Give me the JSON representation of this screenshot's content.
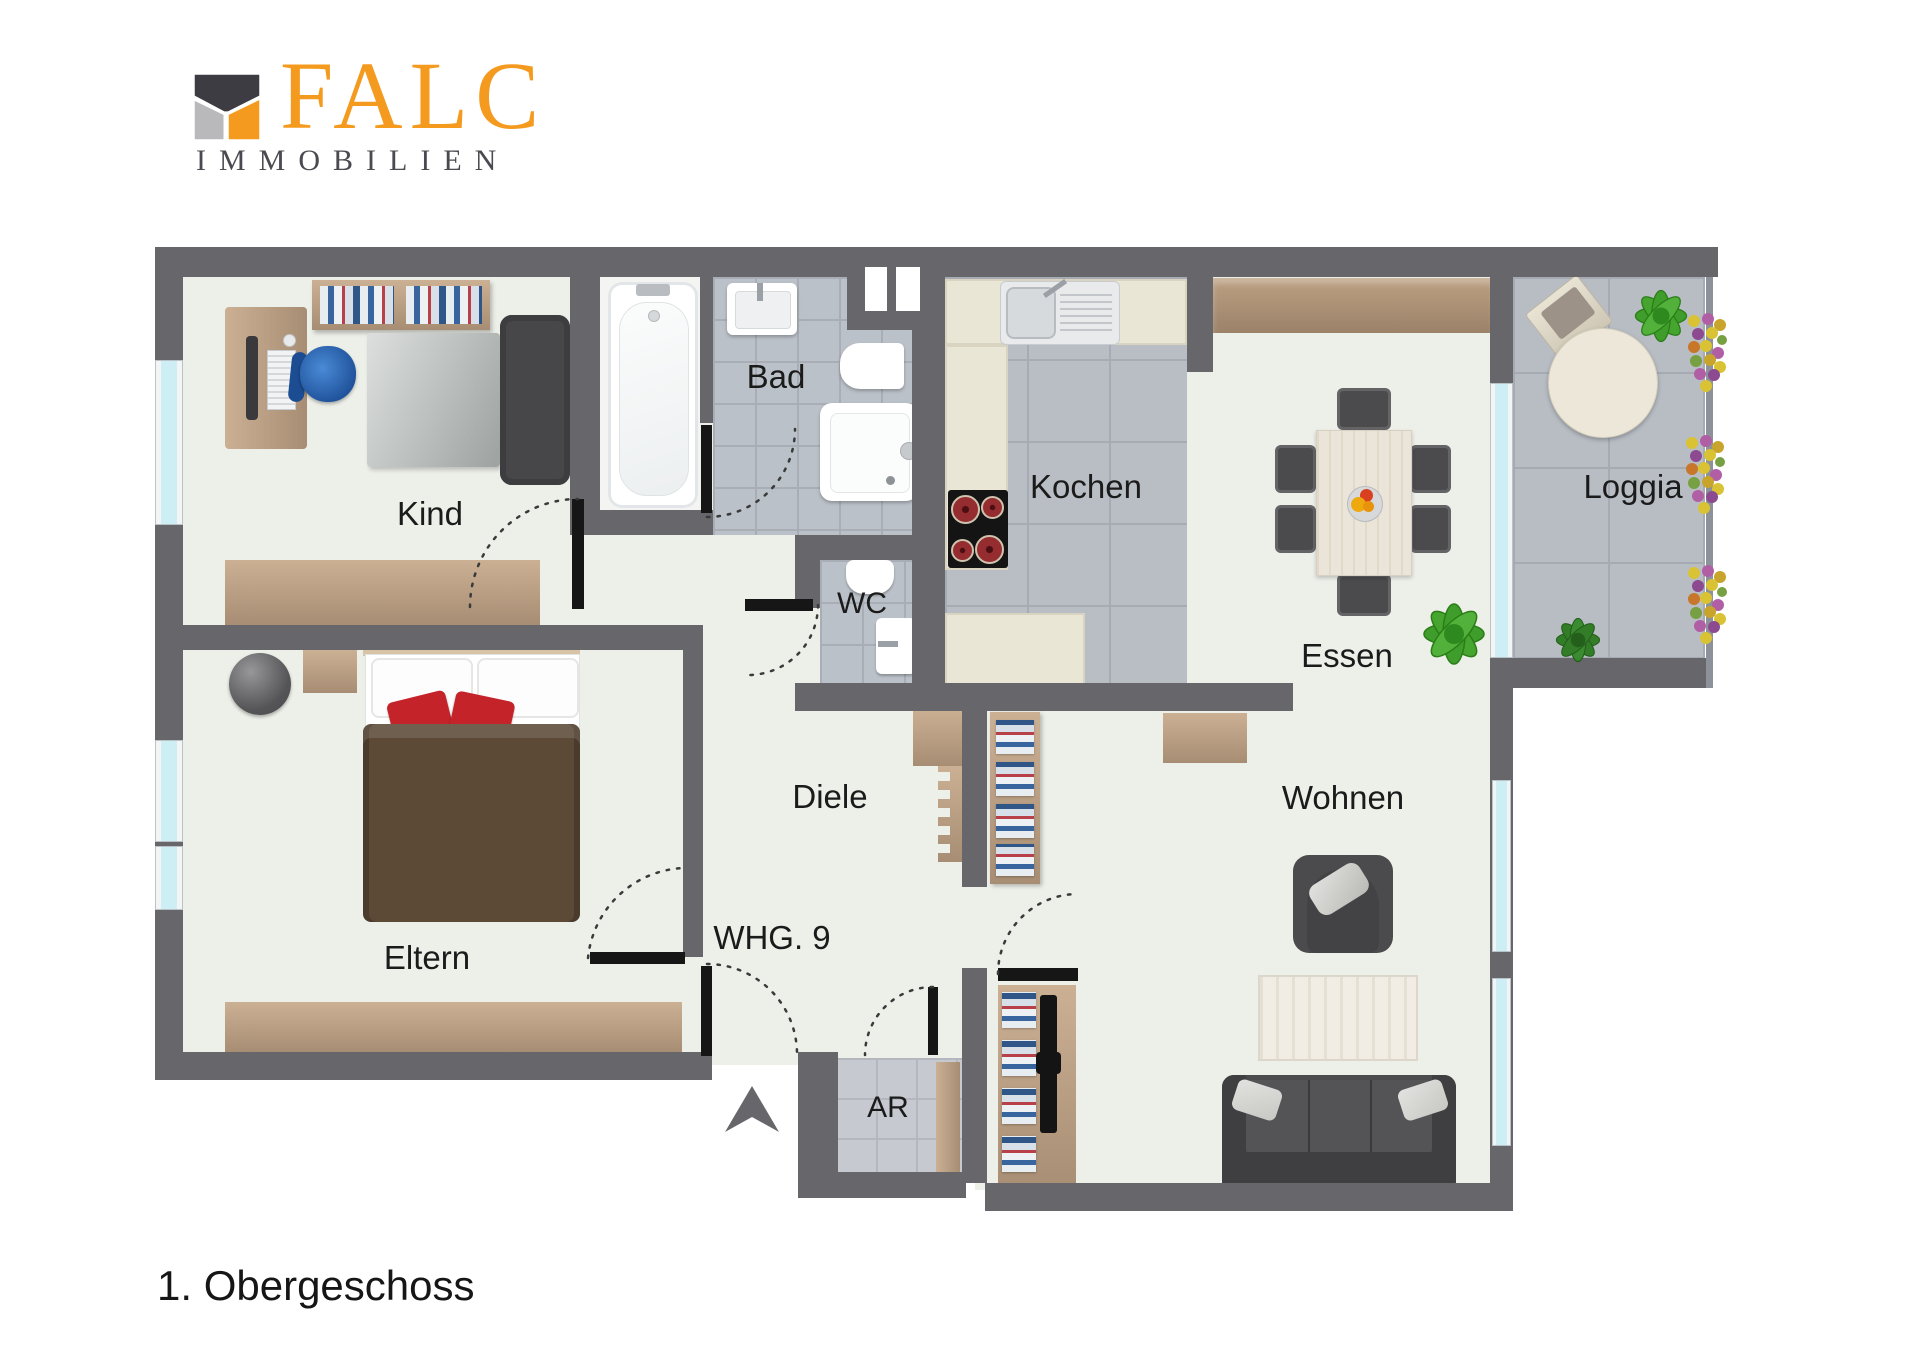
{
  "logo": {
    "brand": "FALC",
    "subtitle": "IMMOBILIEN"
  },
  "plan": {
    "floor_label": "1. Obergeschoss",
    "apartment_label": "WHG. 9",
    "rooms": {
      "kind": "Kind",
      "bad": "Bad",
      "wc": "WC",
      "kochen": "Kochen",
      "essen": "Essen",
      "loggia": "Loggia",
      "diele": "Diele",
      "wohnen": "Wohnen",
      "eltern": "Eltern",
      "ar": "AR"
    }
  },
  "colors": {
    "brand_orange": "#f49b1f",
    "wall": "#67676b",
    "window_glass": "#cdeef4",
    "floor": "#edefe9"
  }
}
